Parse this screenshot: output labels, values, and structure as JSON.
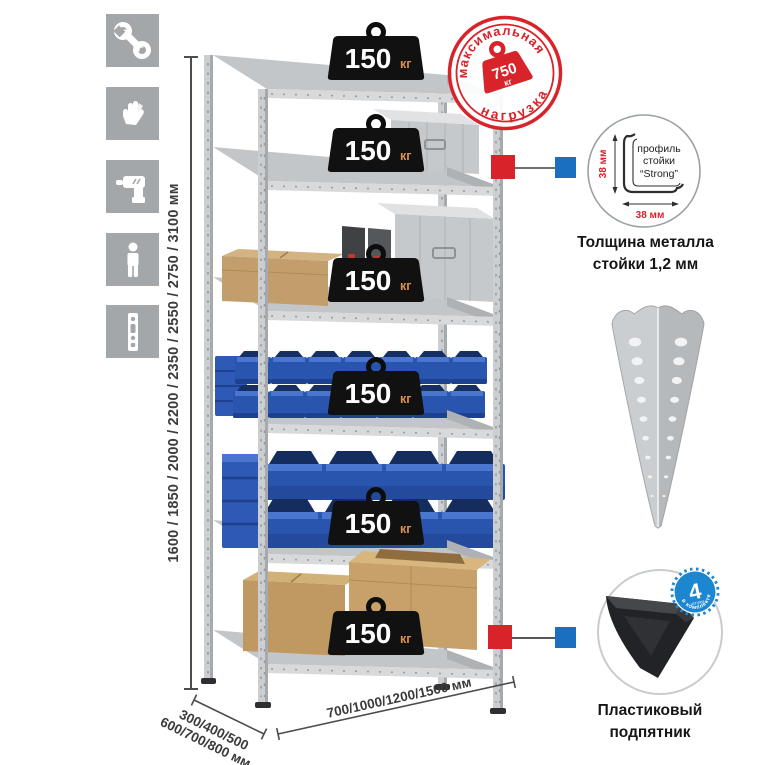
{
  "colors": {
    "accent_red": "#d8232a",
    "accent_blue": "#1b6fc0",
    "badge_black": "#111111",
    "badge_kg_orange": "#dd9050",
    "bin_blue": "#2a55ae",
    "metal_gray": "#cccfd1",
    "icon_tile_gray": "#a4a7aa",
    "count_badge_blue": "#1d86d0"
  },
  "assembly_icons": [
    {
      "name": "wrench"
    },
    {
      "name": "gloves"
    },
    {
      "name": "drill"
    },
    {
      "name": "person"
    },
    {
      "name": "upright-post"
    }
  ],
  "height_dimension": {
    "label": "1600 / 1850 / 2000 / 2200 / 2350 / 2550 / 2750 / 3100 мм"
  },
  "rack": {
    "shelves": [
      {
        "load": "150",
        "unit": "кг",
        "contents": "empty"
      },
      {
        "load": "150",
        "unit": "кг",
        "contents": "aluminum case"
      },
      {
        "load": "150",
        "unit": "кг",
        "contents": "cardboard box and cases"
      },
      {
        "load": "150",
        "unit": "кг",
        "contents": "small blue stacking bins"
      },
      {
        "load": "150",
        "unit": "кг",
        "contents": "large blue stacking bins"
      },
      {
        "load": "150",
        "unit": "кг",
        "contents": "cardboard boxes"
      }
    ]
  },
  "max_load_stamp": {
    "arc_top": "максимальная",
    "arc_bottom": "нагрузка",
    "value": "750",
    "unit": "кг"
  },
  "profile_detail": {
    "label_line1": "профиль",
    "label_line2": "стойки",
    "label_line3": "“Strong”",
    "dim_vertical": "38 мм",
    "dim_horizontal": "38 мм",
    "caption_line1": "Толщина металла",
    "caption_line2": "стойки 1,2 мм"
  },
  "foot_detail": {
    "count": "4",
    "count_small": "штуки",
    "count_arc": "в комплекте",
    "caption_line1": "Пластиковый",
    "caption_line2": "подпятник"
  },
  "depth_dimension": {
    "line1": "300/400/500",
    "line2": "600/700/800 мм"
  },
  "width_dimension": {
    "label": "700/1000/1200/1500 мм"
  }
}
